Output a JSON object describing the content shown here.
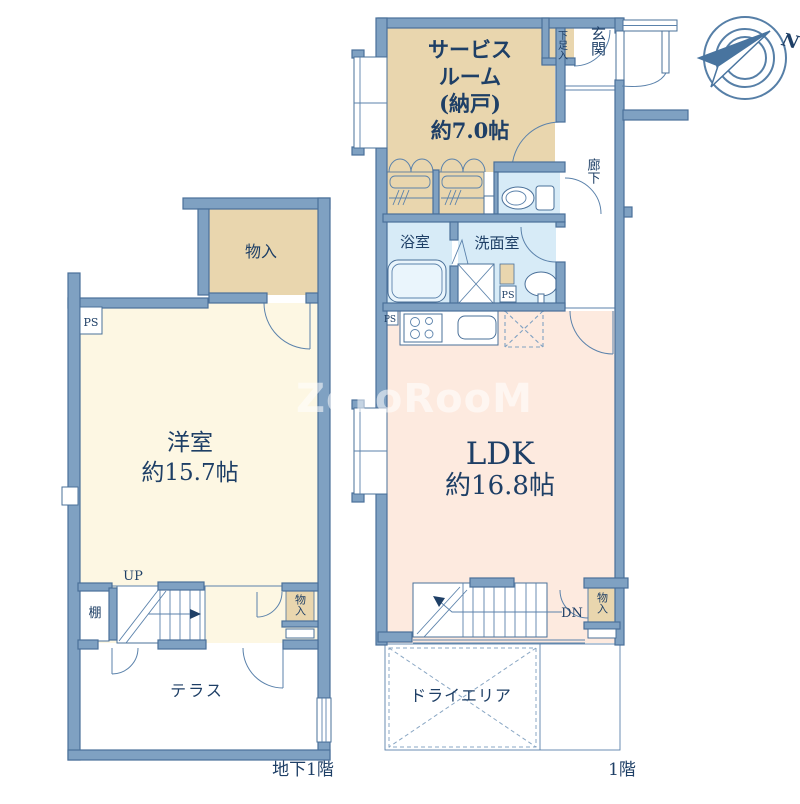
{
  "b1f": {
    "floor_label": "地下1階",
    "western_room_name": "洋室",
    "western_room_size": "約15.7帖",
    "closet_top": "物入",
    "closet_bottom": "物入",
    "shelf": "棚",
    "stairs_up": "UP",
    "terrace": "テラス",
    "ps": "PS"
  },
  "f1": {
    "floor_label": "1階",
    "service_room_line1": "サービス",
    "service_room_line2": "ルーム",
    "service_room_line3": "(納戸)",
    "service_room_line4": "約7.0帖",
    "shoe_cabinet": "下足入",
    "entrance": "玄関",
    "hallway": "廊下",
    "bathroom": "浴室",
    "washroom": "洗面室",
    "ldk_name": "LDK",
    "ldk_size": "約16.8帖",
    "closet": "物入",
    "stairs_down": "DN",
    "dry_area": "ドライエリア",
    "ps_kitchen": "PS",
    "ps_washroom": "PS"
  },
  "compass": {
    "north_label": "N"
  },
  "watermark": {
    "text": "ZeroRooM"
  },
  "colors": {
    "wall_fill": "#7fa1c2",
    "wall_stroke": "#4a7099",
    "room_tan": "#e9d6ae",
    "room_cream": "#fdf7e3",
    "room_pink": "#fdeadf",
    "room_light_blue": "#d7ebf7",
    "text_navy": "#1e3f66",
    "compass_blue": "#48749f",
    "watermark_white": "#ffffff"
  }
}
